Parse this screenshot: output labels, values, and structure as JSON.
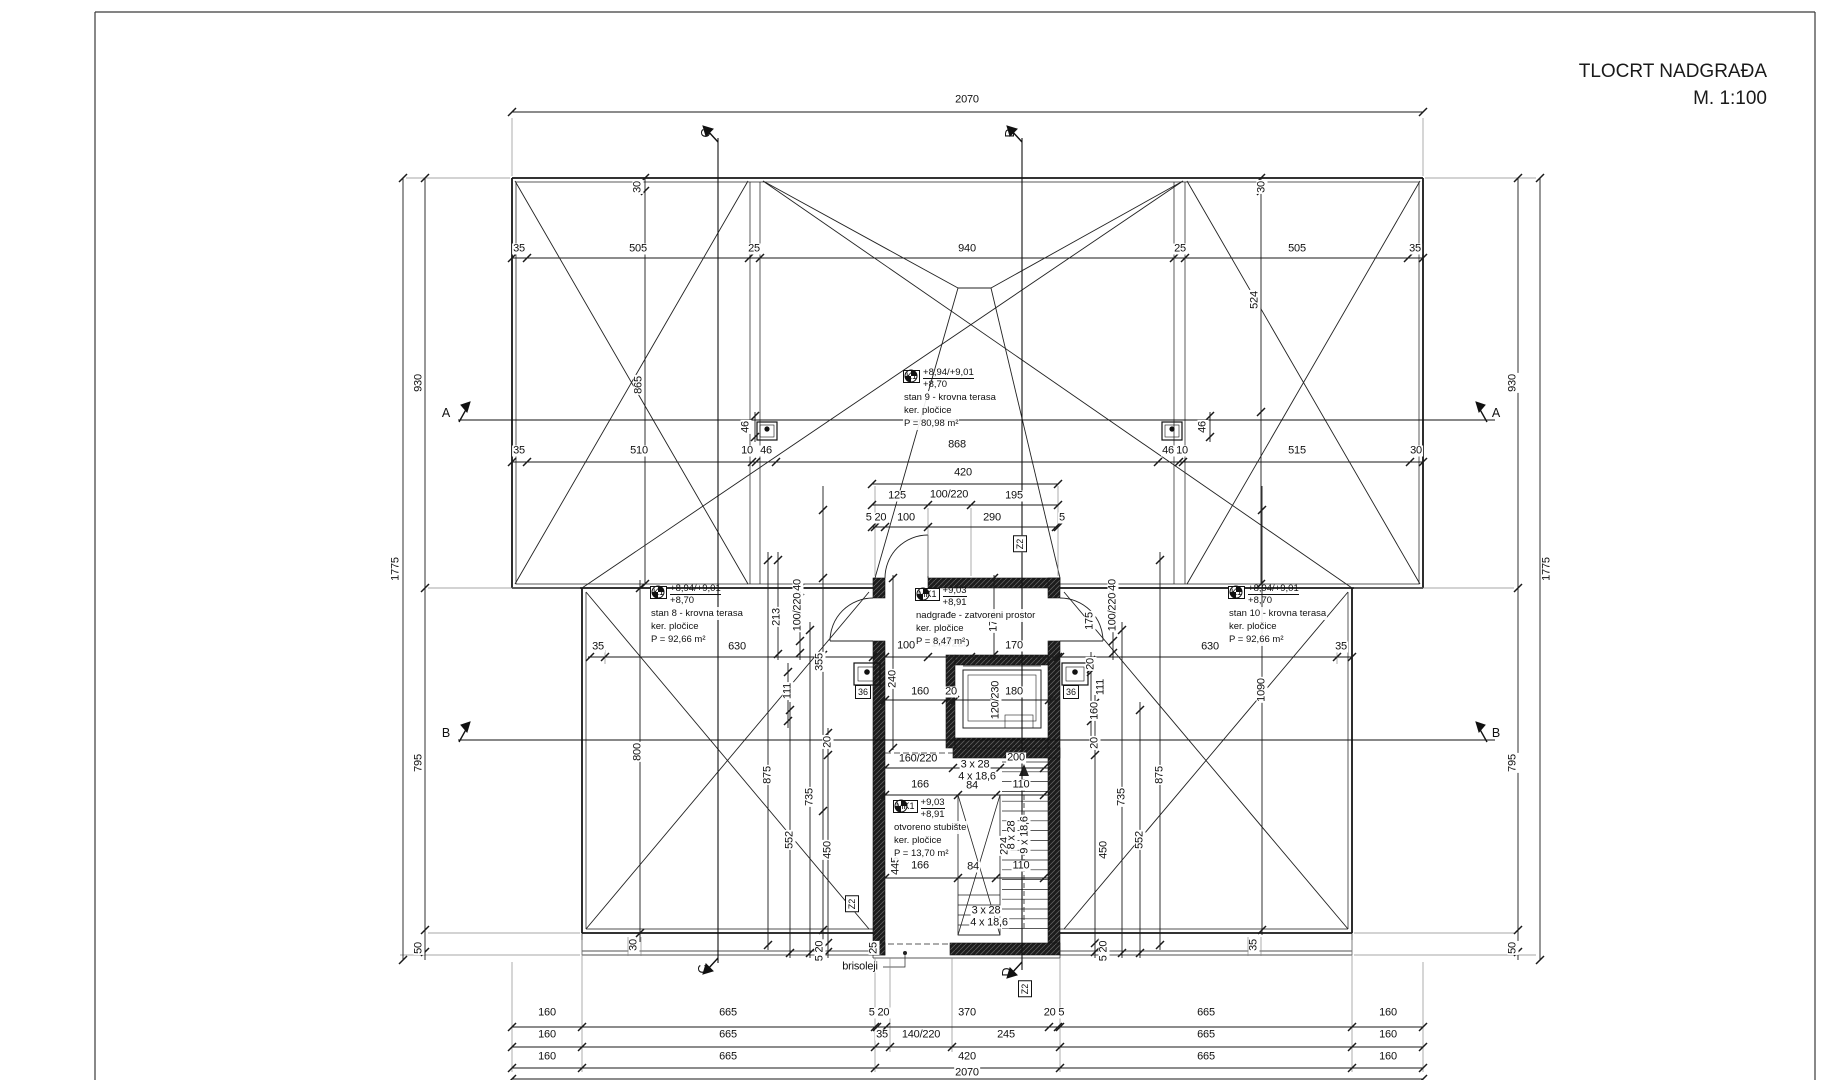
{
  "title": {
    "line1": "TLOCRT NADGRAĐA",
    "line2": "M. 1:100"
  },
  "annotations": {
    "stan8": {
      "tag": "K1",
      "elev_top": "+8,94/+9,01",
      "elev_bot": "+8,70",
      "name": "stan 8 - krovna terasa",
      "mat": "ker. pločice",
      "area": "P = 92,66 m²"
    },
    "stan9": {
      "tag": "K1",
      "elev_top": "+8,94/+9,01",
      "elev_bot": "+8,70",
      "name": "stan 9 - krovna terasa",
      "mat": "ker. pločice",
      "area": "P = 80,98 m²"
    },
    "stan10": {
      "tag": "K1",
      "elev_top": "+8,94/+9,01",
      "elev_bot": "+8,70",
      "name": "stan 10 - krovna terasa",
      "mat": "ker. pločice",
      "area": "P = 92,66 m²"
    },
    "nadgrade": {
      "tag": "MK1",
      "elev_top": "+9,03",
      "elev_bot": "+8,91",
      "name": "nadgrađe - zatvoreni prostor",
      "mat": "ker. pločice",
      "area": "P = 8,47 m²"
    },
    "stubiste": {
      "tag": "MK1",
      "elev_top": "+9,03",
      "elev_bot": "+8,91",
      "name": "otvoreno stubište",
      "mat": "ker. pločice",
      "area": "P = 13,70 m²"
    }
  },
  "labels": [
    {
      "t": "2070",
      "x": 967,
      "y": 100
    },
    {
      "t": "35",
      "x": 519,
      "y": 249
    },
    {
      "t": "505",
      "x": 638,
      "y": 249
    },
    {
      "t": "25",
      "x": 754,
      "y": 249
    },
    {
      "t": "940",
      "x": 967,
      "y": 249
    },
    {
      "t": "25",
      "x": 1180,
      "y": 249
    },
    {
      "t": "505",
      "x": 1297,
      "y": 249
    },
    {
      "t": "35",
      "x": 1415,
      "y": 249
    },
    {
      "t": "30",
      "x": 638,
      "y": 187,
      "r": 1
    },
    {
      "t": "30",
      "x": 1262,
      "y": 187,
      "r": 1
    },
    {
      "t": "865",
      "x": 639,
      "y": 385,
      "r": 1
    },
    {
      "t": "524",
      "x": 1255,
      "y": 300,
      "r": 1
    },
    {
      "t": "35",
      "x": 519,
      "y": 451
    },
    {
      "t": "510",
      "x": 639,
      "y": 451
    },
    {
      "t": "10",
      "x": 747,
      "y": 451
    },
    {
      "t": "46",
      "x": 766,
      "y": 451
    },
    {
      "t": "868",
      "x": 957,
      "y": 445
    },
    {
      "t": "46",
      "x": 1168,
      "y": 451
    },
    {
      "t": "10",
      "x": 1182,
      "y": 451
    },
    {
      "t": "515",
      "x": 1297,
      "y": 451
    },
    {
      "t": "30",
      "x": 1416,
      "y": 451
    },
    {
      "t": "46",
      "x": 746,
      "y": 427,
      "r": 1
    },
    {
      "t": "46",
      "x": 1203,
      "y": 427,
      "r": 1
    },
    {
      "t": "420",
      "x": 963,
      "y": 473
    },
    {
      "t": "125",
      "x": 897,
      "y": 496
    },
    {
      "t": "100/220",
      "x": 949,
      "y": 495
    },
    {
      "t": "195",
      "x": 1014,
      "y": 496
    },
    {
      "t": "5 20",
      "x": 876,
      "y": 518
    },
    {
      "t": "100",
      "x": 906,
      "y": 518
    },
    {
      "t": "290",
      "x": 992,
      "y": 518
    },
    {
      "t": "5",
      "x": 1062,
      "y": 518
    },
    {
      "t": "1775",
      "x": 396,
      "y": 569,
      "r": 1
    },
    {
      "t": "930",
      "x": 419,
      "y": 383,
      "r": 1
    },
    {
      "t": "795",
      "x": 419,
      "y": 763,
      "r": 1
    },
    {
      "t": "50",
      "x": 419,
      "y": 948,
      "r": 1
    },
    {
      "t": "1775",
      "x": 1547,
      "y": 569,
      "r": 1
    },
    {
      "t": "930",
      "x": 1513,
      "y": 383,
      "r": 1
    },
    {
      "t": "795",
      "x": 1513,
      "y": 763,
      "r": 1
    },
    {
      "t": "50",
      "x": 1513,
      "y": 948,
      "r": 1
    },
    {
      "t": "35",
      "x": 598,
      "y": 647
    },
    {
      "t": "630",
      "x": 737,
      "y": 647
    },
    {
      "t": "630",
      "x": 1210,
      "y": 647
    },
    {
      "t": "35",
      "x": 1341,
      "y": 647
    },
    {
      "t": "800",
      "x": 638,
      "y": 752,
      "r": 1
    },
    {
      "t": "875",
      "x": 768,
      "y": 775,
      "r": 1
    },
    {
      "t": "875",
      "x": 1160,
      "y": 775,
      "r": 1
    },
    {
      "t": "1090",
      "x": 1262,
      "y": 690,
      "r": 1
    },
    {
      "t": "213",
      "x": 777,
      "y": 617,
      "r": 1
    },
    {
      "t": "355",
      "x": 820,
      "y": 662,
      "r": 1
    },
    {
      "t": "111",
      "x": 788,
      "y": 691,
      "r": 1
    },
    {
      "t": "735",
      "x": 810,
      "y": 797,
      "r": 1
    },
    {
      "t": "552",
      "x": 790,
      "y": 840,
      "r": 1
    },
    {
      "t": "450",
      "x": 828,
      "y": 850,
      "r": 1
    },
    {
      "t": "20",
      "x": 828,
      "y": 742,
      "r": 1
    },
    {
      "t": "5 20",
      "x": 820,
      "y": 951,
      "r": 1
    },
    {
      "t": "100/220",
      "x": 798,
      "y": 612,
      "r": 1
    },
    {
      "t": "40",
      "x": 798,
      "y": 585,
      "r": 1
    },
    {
      "t": "20",
      "x": 1091,
      "y": 664,
      "r": 1
    },
    {
      "t": "111",
      "x": 1101,
      "y": 687,
      "r": 1
    },
    {
      "t": "160",
      "x": 1095,
      "y": 711,
      "r": 1
    },
    {
      "t": "20",
      "x": 1095,
      "y": 743,
      "r": 1
    },
    {
      "t": "100/220",
      "x": 1113,
      "y": 612,
      "r": 1
    },
    {
      "t": "40",
      "x": 1113,
      "y": 585,
      "r": 1
    },
    {
      "t": "175",
      "x": 994,
      "y": 623,
      "r": 1
    },
    {
      "t": "175",
      "x": 1090,
      "y": 621,
      "r": 1
    },
    {
      "t": "735",
      "x": 1122,
      "y": 797,
      "r": 1
    },
    {
      "t": "552",
      "x": 1140,
      "y": 840,
      "r": 1
    },
    {
      "t": "450",
      "x": 1104,
      "y": 850,
      "r": 1
    },
    {
      "t": "5 20",
      "x": 1104,
      "y": 951,
      "r": 1
    },
    {
      "t": "25",
      "x": 874,
      "y": 948,
      "r": 1
    },
    {
      "t": "100",
      "x": 906,
      "y": 646
    },
    {
      "t": "100/220",
      "x": 950,
      "y": 644
    },
    {
      "t": "170",
      "x": 1014,
      "y": 646
    },
    {
      "t": "240",
      "x": 893,
      "y": 679,
      "r": 1
    },
    {
      "t": "160",
      "x": 920,
      "y": 692
    },
    {
      "t": "20",
      "x": 951,
      "y": 692
    },
    {
      "t": "120/230",
      "x": 996,
      "y": 700,
      "r": 1
    },
    {
      "t": "180",
      "x": 1014,
      "y": 692
    },
    {
      "t": "160/220",
      "x": 918,
      "y": 759
    },
    {
      "t": "200",
      "x": 1016,
      "y": 758
    },
    {
      "t": "3 x 28",
      "x": 975,
      "y": 765
    },
    {
      "t": "4 x 18,6",
      "x": 977,
      "y": 777
    },
    {
      "t": "166",
      "x": 920,
      "y": 785
    },
    {
      "t": "84",
      "x": 972,
      "y": 786
    },
    {
      "t": "110",
      "x": 1021,
      "y": 785
    },
    {
      "t": "445",
      "x": 896,
      "y": 866,
      "r": 1
    },
    {
      "t": "166",
      "x": 920,
      "y": 866
    },
    {
      "t": "84",
      "x": 973,
      "y": 867
    },
    {
      "t": "110",
      "x": 1021,
      "y": 866
    },
    {
      "t": "224",
      "x": 1005,
      "y": 846,
      "r": 1
    },
    {
      "t": "8 x 28",
      "x": 1012,
      "y": 835,
      "r": 1
    },
    {
      "t": "9 x 18,6",
      "x": 1025,
      "y": 835,
      "r": 1
    },
    {
      "t": "3 x 28",
      "x": 986,
      "y": 911
    },
    {
      "t": "4 x 18,6",
      "x": 989,
      "y": 923
    },
    {
      "t": "brisoleji",
      "x": 860,
      "y": 967
    },
    {
      "t": "30",
      "x": 634,
      "y": 945,
      "r": 1
    },
    {
      "t": "35",
      "x": 1254,
      "y": 945,
      "r": 1
    },
    {
      "t": "160",
      "x": 547,
      "y": 1013
    },
    {
      "t": "665",
      "x": 728,
      "y": 1013
    },
    {
      "t": "5 20",
      "x": 879,
      "y": 1013
    },
    {
      "t": "370",
      "x": 967,
      "y": 1013
    },
    {
      "t": "20 5",
      "x": 1054,
      "y": 1013
    },
    {
      "t": "665",
      "x": 1206,
      "y": 1013
    },
    {
      "t": "160",
      "x": 1388,
      "y": 1013
    },
    {
      "t": "160",
      "x": 547,
      "y": 1035
    },
    {
      "t": "665",
      "x": 728,
      "y": 1035
    },
    {
      "t": "35",
      "x": 882,
      "y": 1035
    },
    {
      "t": "140/220",
      "x": 921,
      "y": 1035
    },
    {
      "t": "245",
      "x": 1006,
      "y": 1035
    },
    {
      "t": "665",
      "x": 1206,
      "y": 1035
    },
    {
      "t": "160",
      "x": 1388,
      "y": 1035
    },
    {
      "t": "160",
      "x": 547,
      "y": 1057
    },
    {
      "t": "665",
      "x": 728,
      "y": 1057
    },
    {
      "t": "420",
      "x": 967,
      "y": 1057
    },
    {
      "t": "665",
      "x": 1206,
      "y": 1057
    },
    {
      "t": "160",
      "x": 1388,
      "y": 1057
    },
    {
      "t": "2070",
      "x": 967,
      "y": 1073
    }
  ],
  "section_markers": [
    {
      "t": "A",
      "x": 446,
      "y": 413
    },
    {
      "t": "A",
      "x": 1496,
      "y": 413
    },
    {
      "t": "B",
      "x": 446,
      "y": 733
    },
    {
      "t": "B",
      "x": 1496,
      "y": 733
    },
    {
      "t": "C",
      "x": 706,
      "y": 133,
      "r": 1
    },
    {
      "t": "D",
      "x": 1010,
      "y": 133,
      "r": 1
    },
    {
      "t": "C",
      "x": 703,
      "y": 969,
      "r": 1
    },
    {
      "t": "D",
      "x": 1007,
      "y": 972,
      "r": 1
    }
  ],
  "boxed_tags": [
    {
      "t": "Z2",
      "x": 1020,
      "y": 544,
      "r": 1
    },
    {
      "t": "Z2",
      "x": 852,
      "y": 904,
      "r": 1
    },
    {
      "t": "Z2",
      "x": 1025,
      "y": 989,
      "r": 1
    },
    {
      "t": "36",
      "x": 863,
      "y": 692
    },
    {
      "t": "36",
      "x": 1071,
      "y": 692
    }
  ],
  "colors": {
    "line": "#1a1a1a",
    "wall": "#1c1c1c",
    "ext": "#8a8a8a",
    "paper": "#ffffff"
  }
}
